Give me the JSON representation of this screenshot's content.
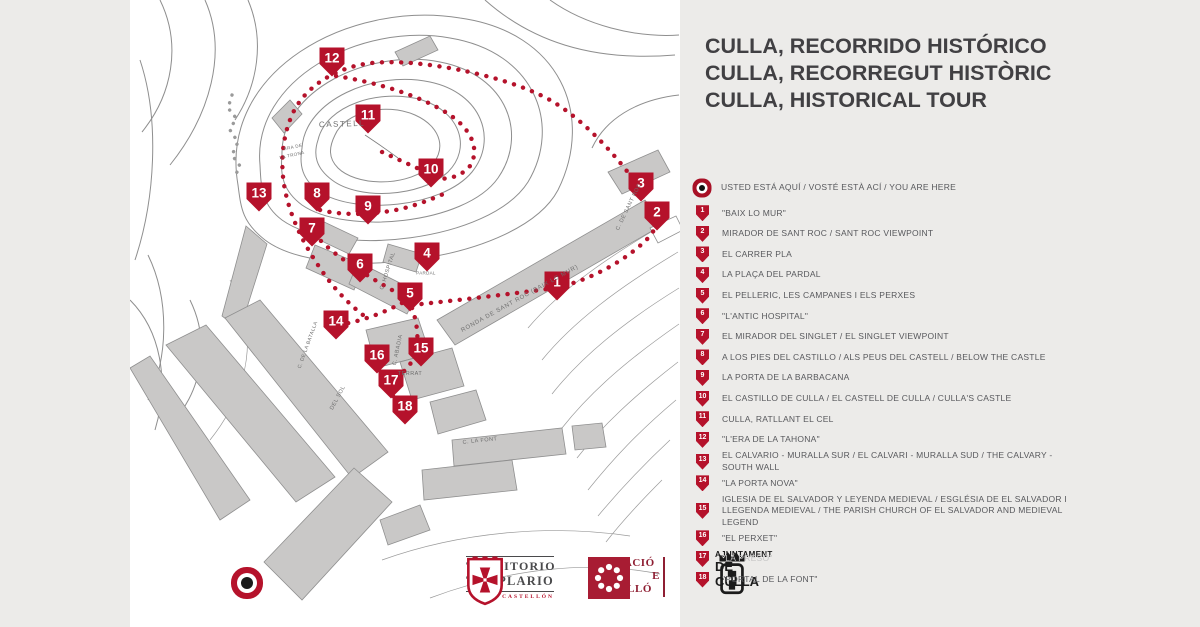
{
  "title": {
    "lines": [
      "CULLA, RECORRIDO HISTÓRICO",
      "CULLA, RECORREGUT HISTÒRIC",
      "CULLA, HISTORICAL TOUR"
    ]
  },
  "legend": {
    "you_are_here": "USTED ESTÁ AQUÍ / VOSTÉ ESTÀ ACÍ / YOU ARE HERE",
    "items": [
      {
        "n": "1",
        "label": "\"BAIX LO MUR\""
      },
      {
        "n": "2",
        "label": "MIRADOR DE SANT ROC / SANT ROC VIEWPOINT"
      },
      {
        "n": "3",
        "label": "EL CARRER PLA"
      },
      {
        "n": "4",
        "label": "LA PLAÇA DEL PARDAL"
      },
      {
        "n": "5",
        "label": "EL PELLERIC, LES CAMPANES I ELS PERXES"
      },
      {
        "n": "6",
        "label": "\"L'ANTIC HOSPITAL\""
      },
      {
        "n": "7",
        "label": "EL MIRADOR DEL SINGLET / EL SINGLET VIEWPOINT"
      },
      {
        "n": "8",
        "label": "A LOS PIES DEL CASTILLO / ALS PEUS DEL CASTELL / BELOW THE CASTLE"
      },
      {
        "n": "9",
        "label": "LA PORTA DE LA BARBACANA"
      },
      {
        "n": "10",
        "label": "EL CASTILLO DE CULLA / EL CASTELL DE CULLA / CULLA'S CASTLE"
      },
      {
        "n": "11",
        "label": "CULLA, RATLLANT EL CEL"
      },
      {
        "n": "12",
        "label": "\"L'ERA DE LA TAHONA\""
      },
      {
        "n": "13",
        "label": "EL CALVARIO - MURALLA SUR / EL CALVARI - MURALLA SUD / THE CALVARY - SOUTH WALL"
      },
      {
        "n": "14",
        "label": "\"LA PORTA NOVA\""
      },
      {
        "n": "15",
        "label": "IGLESIA DE EL SALVADOR Y LEYENDA MEDIEVAL / ESGLÉSIA DE EL SALVADOR I LLEGENDA MEDIEVAL / THE PARISH CHURCH OF EL SALVADOR AND MEDIEVAL LEGEND"
      },
      {
        "n": "16",
        "label": "\"EL PERXET\""
      },
      {
        "n": "17",
        "label": "\"LA PRESÓ\"",
        "muted": true
      },
      {
        "n": "18",
        "label": "\"PORTAL DE LA FONT\""
      }
    ]
  },
  "map": {
    "markers": [
      {
        "n": "1",
        "x": 427,
        "y": 286
      },
      {
        "n": "2",
        "x": 527,
        "y": 216
      },
      {
        "n": "3",
        "x": 511,
        "y": 187
      },
      {
        "n": "4",
        "x": 297,
        "y": 257
      },
      {
        "n": "5",
        "x": 280,
        "y": 297
      },
      {
        "n": "6",
        "x": 230,
        "y": 268
      },
      {
        "n": "7",
        "x": 182,
        "y": 232
      },
      {
        "n": "8",
        "x": 187,
        "y": 197
      },
      {
        "n": "9",
        "x": 238,
        "y": 210
      },
      {
        "n": "10",
        "x": 301,
        "y": 173
      },
      {
        "n": "11",
        "x": 238,
        "y": 119
      },
      {
        "n": "12",
        "x": 202,
        "y": 62
      },
      {
        "n": "13",
        "x": 129,
        "y": 197
      },
      {
        "n": "14",
        "x": 206,
        "y": 325
      },
      {
        "n": "15",
        "x": 291,
        "y": 352
      },
      {
        "n": "16",
        "x": 247,
        "y": 359
      },
      {
        "n": "17",
        "x": 261,
        "y": 384
      },
      {
        "n": "18",
        "x": 275,
        "y": 410
      }
    ],
    "labels": [
      {
        "t": "CASTELL",
        "x": 212,
        "y": 124,
        "r": -2,
        "s": 8,
        "ls": 1.5
      },
      {
        "t": "ERA DE",
        "x": 163,
        "y": 147,
        "r": -12,
        "s": 4.5,
        "ls": 0.4
      },
      {
        "t": "LA TRONA",
        "x": 162,
        "y": 155,
        "r": -12,
        "s": 4.5,
        "ls": 0.4
      },
      {
        "t": "RONDA DE SANT ROC (BAIX LO MUR)",
        "x": 390,
        "y": 299,
        "r": -29,
        "s": 6,
        "ls": 0.8
      },
      {
        "t": "C. DE SANT ROC",
        "x": 499,
        "y": 207,
        "r": -64,
        "s": 5.5,
        "ls": 0.5
      },
      {
        "t": "C. HOSPITAL",
        "x": 258,
        "y": 271,
        "r": -72,
        "s": 5.5,
        "ls": 0.5
      },
      {
        "t": "C. ABADIA",
        "x": 268,
        "y": 350,
        "r": -78,
        "s": 5.5,
        "ls": 0.5
      },
      {
        "t": "TERRAT",
        "x": 280,
        "y": 374,
        "r": 0,
        "s": 5.5,
        "ls": 0.5
      },
      {
        "t": "DEL SOL",
        "x": 208,
        "y": 398,
        "r": -62,
        "s": 5.5,
        "ls": 0.5
      },
      {
        "t": "C. LA FONT",
        "x": 350,
        "y": 441,
        "r": -6,
        "s": 5.5,
        "ls": 0.5
      },
      {
        "t": "C. DE LA BATALLA",
        "x": 178,
        "y": 345,
        "r": -70,
        "s": 5,
        "ls": 0.4
      },
      {
        "t": "PARDAL",
        "x": 296,
        "y": 273,
        "r": 0,
        "s": 4.5,
        "ls": 0.3
      }
    ],
    "you_are_here": {
      "x": 117,
      "y": 583
    }
  },
  "logos": {
    "territorio": {
      "line1": "TERRITORIO",
      "line2": "TEMPLARIO",
      "line3": "CASTELLÓN"
    },
    "diputacio": {
      "line1": "DIPUTACIÓ",
      "line2a": "D",
      "line2b": "E",
      "line3": "CASTELLÓ"
    },
    "ajuntament": {
      "line1": "AJUNTAMENT",
      "line2": "DE CULLA"
    }
  },
  "colors": {
    "accent": "#b5122b",
    "panel": "#ecebe9",
    "ink": "#57585c",
    "muted": "#c6c6c6",
    "title": "#414043"
  }
}
